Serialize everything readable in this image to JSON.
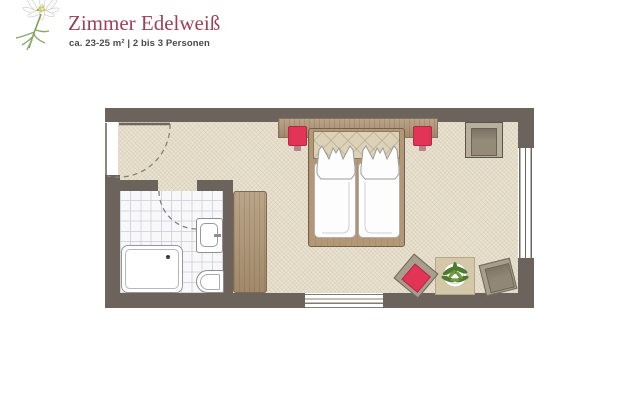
{
  "header": {
    "title": "Zimmer Edelweiß",
    "subtitle": "ca. 23-25 m² | 2 bis 3 Personen"
  },
  "logo": {
    "icon": "edelweiss-flower-icon"
  },
  "palette": {
    "title_text": "#9d4157",
    "subtitle_text": "#4a4a48",
    "wall": "#6b635c",
    "floor": "#e9e2d0",
    "bath_tile": "#f8f8fa",
    "wood": "#ab9170",
    "bed_frame": "#b29877",
    "accent_red": "#e23457",
    "chair_gray": "#a89e8c",
    "table_beige": "#d4c8a8",
    "plant_green": "#4e7a2d"
  }
}
